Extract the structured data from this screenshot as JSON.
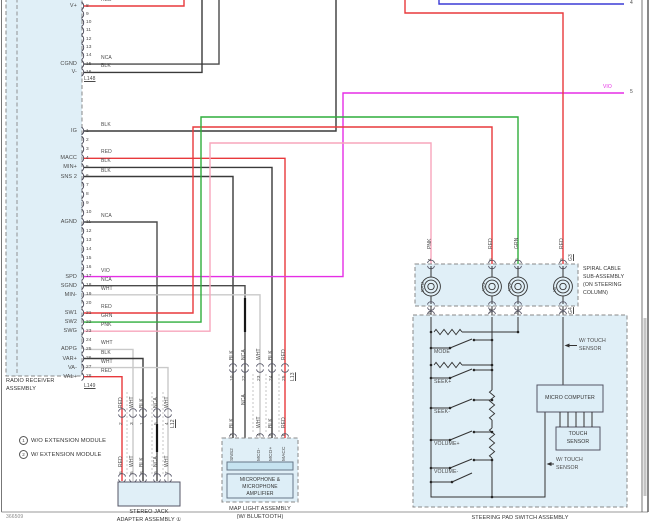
{
  "page": {
    "footer_id": "366509",
    "offpage": {
      "blu_label": "BLU",
      "blu_ref": "4",
      "vio_label": "VIO",
      "vio_ref": "5"
    }
  },
  "colors": {
    "RED": "#e8393c",
    "BLK": "#3a3a3a",
    "WHT": "#c9c9c9",
    "NCA": "#4a4a4a",
    "GRN": "#2fae3b",
    "PNK": "#f7a6bc",
    "VIO": "#e52ee5",
    "BLU": "#3b3bd6"
  },
  "radio": {
    "title_lines": [
      "RADIO RECEIVER",
      "ASSEMBLY"
    ],
    "top_connector": {
      "id": "L148",
      "pins": [
        {
          "n": "8",
          "name": "V+",
          "wire": "RED"
        },
        {
          "n": "9"
        },
        {
          "n": "10"
        },
        {
          "n": "11"
        },
        {
          "n": "12"
        },
        {
          "n": "13"
        },
        {
          "n": "14"
        },
        {
          "n": "15",
          "name": "CGND",
          "wire": "NCA"
        },
        {
          "n": "16",
          "name": "V-",
          "wire": "BLK"
        }
      ]
    },
    "main_connector": {
      "id": "L149",
      "pins": [
        {
          "n": "1",
          "name": "IG",
          "wire": "BLK"
        },
        {
          "n": "2"
        },
        {
          "n": "3"
        },
        {
          "n": "4",
          "name": "MACC",
          "wire": "RED"
        },
        {
          "n": "5",
          "name": "MIN+",
          "wire": "BLK"
        },
        {
          "n": "6",
          "name": "SNS 2",
          "wire": "BLK"
        },
        {
          "n": "7"
        },
        {
          "n": "8"
        },
        {
          "n": "9"
        },
        {
          "n": "10"
        },
        {
          "n": "11",
          "name": "AGND",
          "wire": "NCA"
        },
        {
          "n": "12"
        },
        {
          "n": "13"
        },
        {
          "n": "14"
        },
        {
          "n": "15"
        },
        {
          "n": "16"
        },
        {
          "n": "17",
          "name": "SPD",
          "wire": "VIO"
        },
        {
          "n": "18",
          "name": "SGND",
          "wire": "NCA"
        },
        {
          "n": "19",
          "name": "MIN-",
          "wire": "WHT"
        },
        {
          "n": "20"
        },
        {
          "n": "21",
          "name": "SW1",
          "wire": "RED"
        },
        {
          "n": "22",
          "name": "SW2",
          "wire": "GRN"
        },
        {
          "n": "23",
          "name": "SWG",
          "wire": "PNK"
        },
        {
          "n": "24"
        },
        {
          "n": "25",
          "name": "ADPG",
          "wire": "WHT"
        },
        {
          "n": "26",
          "name": "VAR+",
          "wire": "BLK"
        },
        {
          "n": "27",
          "name": "VA-",
          "wire": "WHT"
        },
        {
          "n": "28",
          "name": "VAL+",
          "wire": "RED"
        }
      ]
    }
  },
  "stereo": {
    "junction_id": "L12",
    "title_lines": [
      "STEREO JACK",
      "ADAPTER ASSEMBLY ①"
    ],
    "wires": [
      {
        "color": "RED",
        "jpin": "2",
        "epin": "6"
      },
      {
        "color": "WHT",
        "jpin": "3",
        "epin": "5"
      },
      {
        "color": "BLK",
        "jpin": "1",
        "epin": "8"
      },
      {
        "color": "NCA",
        "jpin": "5",
        "epin": "9"
      },
      {
        "color": "WHT",
        "jpin": "4",
        "epin": "7"
      }
    ]
  },
  "map_light": {
    "junction_id": "L13",
    "title_lines": [
      "MAP LIGHT ASSEMBLY",
      "(W/ BLUETOOTH)"
    ],
    "amp_lines": [
      "MICROPHONE &",
      "MICROPHONE",
      "AMPLIFIER"
    ],
    "wires": [
      {
        "color": "BLK",
        "jpin": "10",
        "epin": "3",
        "pin_name": "SNS2"
      },
      {
        "color": "NCA",
        "jpin": "22"
      },
      {
        "color": "WHT",
        "jpin": "23",
        "epin": "4",
        "pin_name": "MCO-"
      },
      {
        "color": "BLK",
        "jpin": "24",
        "epin": "5",
        "pin_name": "MCO+"
      },
      {
        "color": "RED",
        "jpin": "25",
        "epin": "6",
        "pin_name": "MACC"
      }
    ]
  },
  "spiral": {
    "top_id": "G3",
    "bottom_id": "G4",
    "label_lines": [
      "SPIRAL CABLE",
      "SUB-ASSEMBLY",
      "(ON STEERING",
      "COLUMN)"
    ],
    "coils": [
      {
        "name": "EAU",
        "top_pin": "4",
        "bottom_pin": "8",
        "wire": "PNK"
      },
      {
        "name": "AU1",
        "top_pin": "6",
        "bottom_pin": "10",
        "wire": "RED"
      },
      {
        "name": "AU2",
        "top_pin": "5",
        "bottom_pin": "9",
        "wire": "GRN"
      },
      {
        "name": "IG",
        "top_pin": "9",
        "bottom_pin": "7",
        "wire": "RED"
      }
    ]
  },
  "steering": {
    "title": "STEERING PAD SWITCH ASSEMBLY",
    "switch_labels": [
      "MODE",
      "SEEK+",
      "SEEK-",
      "VOLUME+",
      "VOLUME-"
    ],
    "micro_label": "MICRO COMPUTER",
    "touch_lines": [
      "TOUCH",
      "SENSOR"
    ],
    "touch_note_lines": [
      "W/ TOUCH",
      "SENSOR"
    ]
  },
  "notes": [
    {
      "marker": "1",
      "text": "W/O EXTENSION MODULE"
    },
    {
      "marker": "2",
      "text": "W/ EXTENSION MODULE"
    }
  ]
}
